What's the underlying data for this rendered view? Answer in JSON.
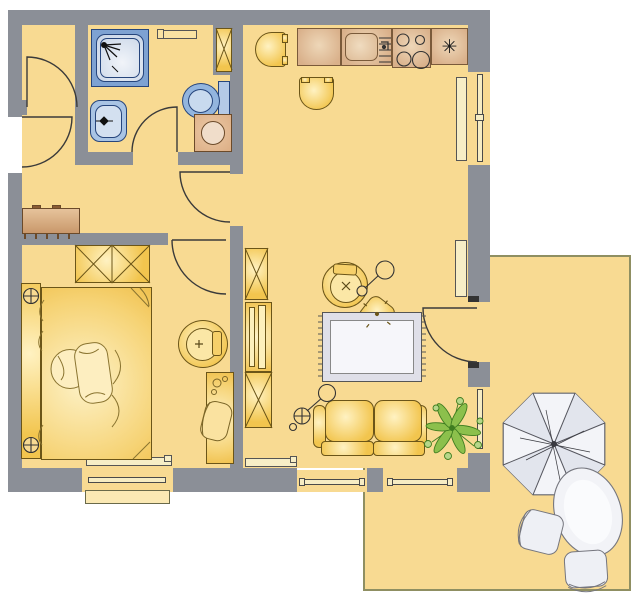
{
  "palette": {
    "background": "#ffffff",
    "wall": "#8b8f97",
    "floor": "#f8da92",
    "terrace_outline": "#8f8f62",
    "furniture_gold": "#f2c54e",
    "furniture_highlight": "#fff2c2",
    "furniture_outline": "#6b5518",
    "furniture_soft": "#fbe7a6",
    "counter_tan": "#d9b08a",
    "counter_light": "#eed7b8",
    "counter_outline": "#7a5a3a",
    "appliance_tan": "#dcae85",
    "appliance_drum": "#f0ddca",
    "blue_dark": "#26457c",
    "blue_mid": "#7ea2d2",
    "blue_body": "#a9c4e4",
    "blue_light": "#d3e0f0",
    "line": "#3a3a3a",
    "frame_fill": "#f6ecc3",
    "frame_line": "#4a4a4a",
    "radiator": "#f7eec6",
    "rug_band": "#dfdfe8",
    "rug_field": "#f6f6fa",
    "rug_line": "#555555",
    "white_furn": "#eef0f5",
    "white_furn_line": "#75767e",
    "plant": "#8cc04c",
    "plant_dark": "#3f7d20",
    "sill": "#fbe9b4"
  },
  "kitchen": {
    "freezer_symbol": "✳"
  },
  "inventory": {
    "rooms": [
      "entry-hall",
      "closet",
      "bathroom",
      "bedroom",
      "living-room-with-kitchen",
      "terrace"
    ],
    "bathroom": [
      "shower",
      "washbasin",
      "toilet",
      "washing-machine",
      "wall-shelf",
      "tall-cabinet"
    ],
    "kitchen_items": [
      "worktop",
      "sink",
      "stove-4-burners",
      "freezer",
      "dining-chair",
      "dining-chair"
    ],
    "bedroom_items": [
      "double-bed",
      "bedside-lamps",
      "wardrobe",
      "sideboard",
      "round-chair",
      "desk-with-chair"
    ],
    "living_items": [
      "armchair",
      "floor-lamp",
      "pouf",
      "rug",
      "sofa",
      "floor-lamp",
      "plant",
      "shelf-unit",
      "two-cabinets"
    ],
    "terrace_items": [
      "parasol",
      "round-table",
      "chair",
      "chair"
    ]
  }
}
